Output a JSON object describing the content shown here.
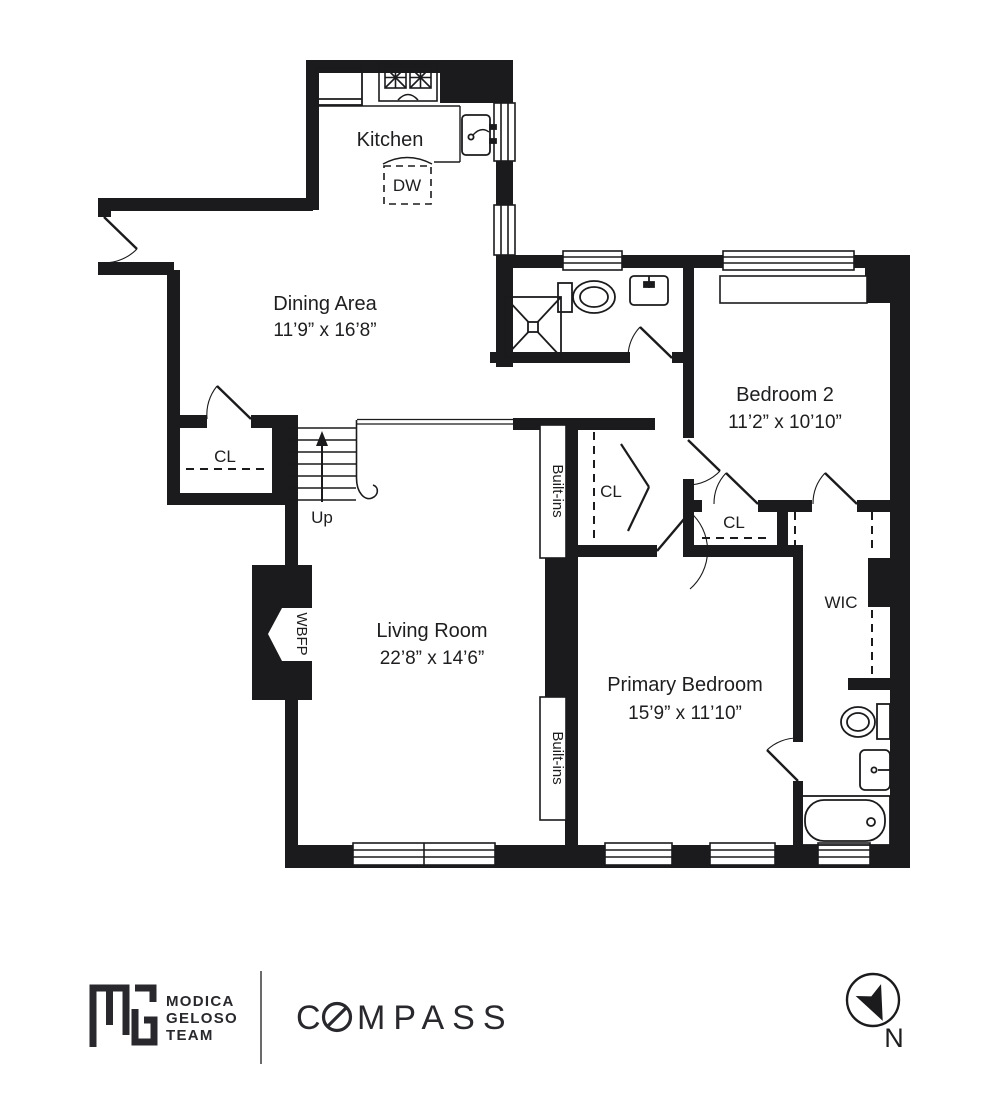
{
  "floor_plan": {
    "rooms": {
      "kitchen": {
        "label": "Kitchen"
      },
      "dining": {
        "label": "Dining Area",
        "dims": "11’9” x 16’8”"
      },
      "bedroom2": {
        "label": "Bedroom 2",
        "dims": "11’2” x 10’10”"
      },
      "living": {
        "label": "Living Room",
        "dims": "22’8” x 14’6”"
      },
      "primary": {
        "label": "Primary Bedroom",
        "dims": "15’9” x 11’10”"
      },
      "wic": {
        "label": "WIC"
      }
    },
    "features": {
      "dishwasher": "DW",
      "stairs_up": "Up",
      "closet": "CL",
      "fireplace": "WBFP",
      "built_ins": "Built-ins"
    },
    "icons": {
      "north_arrow": "compass-north-arrow-icon"
    }
  },
  "footer": {
    "team": {
      "line1": "MODICA",
      "line2": "GELOSO",
      "line3": "TEAM"
    },
    "brokerage": {
      "name_start": "C",
      "name_end": "MPASS"
    },
    "north_label": "N"
  },
  "colors": {
    "ink": "#1b1b1d",
    "divider": "#6b6b6b"
  }
}
